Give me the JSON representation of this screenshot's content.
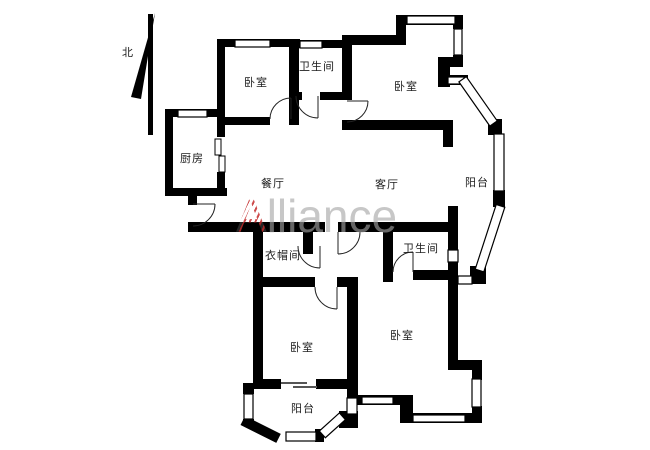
{
  "compass": {
    "north_label": "北"
  },
  "watermark": {
    "initial": "A",
    "rest": "lliance"
  },
  "rooms": {
    "bedroom_top_left": "卧室",
    "bathroom_top": "卫生间",
    "bedroom_top_right": "卧室",
    "kitchen": "厨房",
    "dining_room": "餐厅",
    "living_room": "客厅",
    "balcony_east": "阳台",
    "cloakroom": "衣帽间",
    "bathroom_south": "卫生间",
    "bedroom_bottom_left": "卧室",
    "bedroom_bottom_right": "卧室",
    "balcony_south": "阳台"
  },
  "colors": {
    "wall": "#000000",
    "label_text": "#1c1c1c",
    "watermark_gray": "#a5a5a5",
    "watermark_red": "#c43c3c"
  }
}
